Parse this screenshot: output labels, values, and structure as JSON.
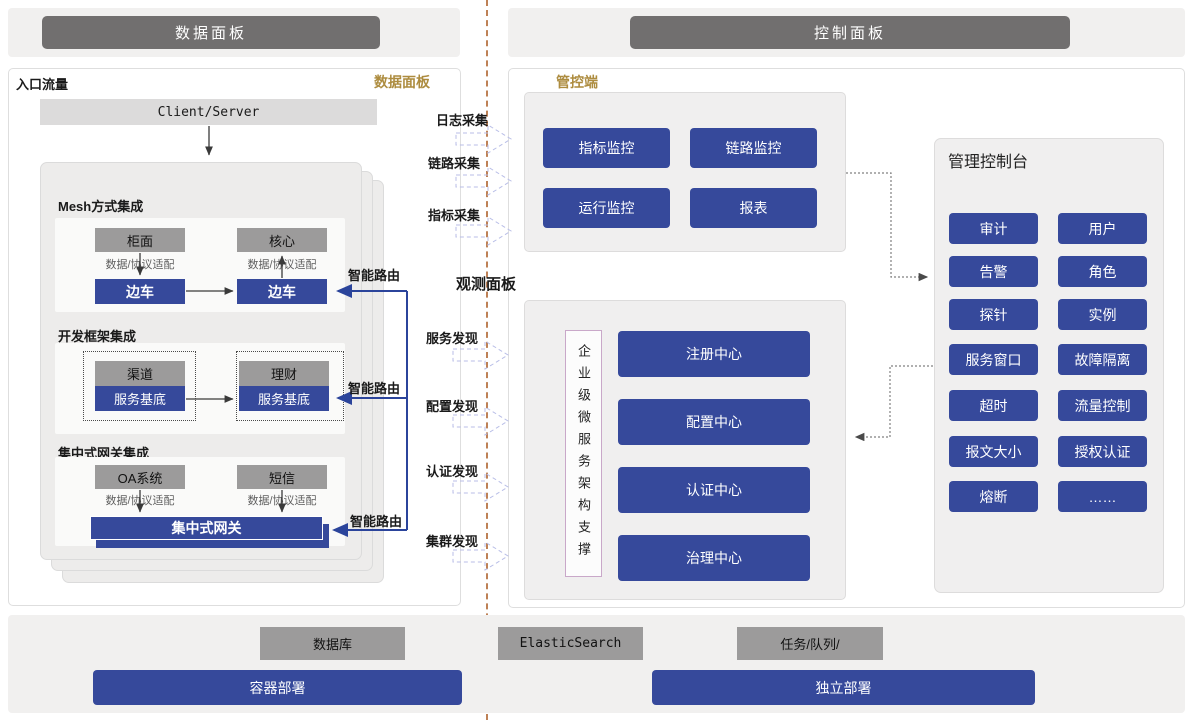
{
  "colors": {
    "blue": "#36499B",
    "dark_gray": "#716F6F",
    "mid_gray": "#9C9B9B",
    "light_bar": "#F1F0EF",
    "gold": "#AD8C3F",
    "divider": "#BE8156",
    "route_blue": "#2B449B"
  },
  "headers": {
    "left": "数据面板",
    "right": "控制面板"
  },
  "data_panel": {
    "entry_label": "入口流量",
    "corner_tag": "数据面板",
    "client_server": "Client/Server",
    "mesh": {
      "title": "Mesh方式集成",
      "top_left": "柜面",
      "top_right": "核心",
      "adapter": "数据/协议适配",
      "sidecar_left": "边车",
      "sidecar_right": "边车"
    },
    "framework": {
      "title": "开发框架集成",
      "top_left": "渠道",
      "top_right": "理财",
      "base_left": "服务基底",
      "base_right": "服务基底"
    },
    "gateway": {
      "title": "集中式网关集成",
      "top_left": "OA系统",
      "top_right": "短信",
      "adapter": "数据/协议适配",
      "gateway_bar": "集中式网关"
    },
    "smart_route": "智能路由"
  },
  "flow": {
    "collect": [
      "日志采集",
      "链路采集",
      "指标采集"
    ],
    "observe_label": "观测面板",
    "discover": [
      "服务发现",
      "配置发现",
      "认证发现",
      "集群发现"
    ]
  },
  "control_plane": {
    "label": "管控端",
    "buttons": [
      "指标监控",
      "链路监控",
      "运行监控",
      "报表"
    ]
  },
  "microservice": {
    "vertical_label": "企业级微服务架构支撑",
    "buttons": [
      "注册中心",
      "配置中心",
      "认证中心",
      "治理中心"
    ]
  },
  "console": {
    "title": "管理控制台",
    "buttons": [
      "审计",
      "用户",
      "告警",
      "角色",
      "探针",
      "实例",
      "服务窗口",
      "故障隔离",
      "超时",
      "流量控制",
      "报文大小",
      "授权认证",
      "熔断",
      "……"
    ]
  },
  "footer": {
    "gray_boxes": [
      "数据库",
      "ElasticSearch",
      "任务/队列/"
    ],
    "blue_boxes": [
      "容器部署",
      "独立部署"
    ]
  }
}
